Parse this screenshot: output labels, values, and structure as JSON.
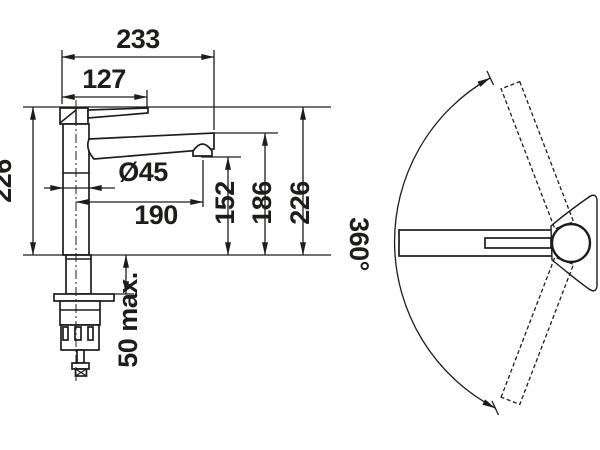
{
  "meta": {
    "description": "Technical dimension drawing of a single-lever kitchen mixer tap: side view with installation dimensions (mm) and top view showing spout swivel range",
    "background_color": "#ffffff",
    "line_color": "#1d1d1b"
  },
  "side_view": {
    "dims": {
      "total_width": "233",
      "lever_length": "127",
      "height_left": "226",
      "body_diameter": "Ø45",
      "spout_reach": "190",
      "outlet_height": "152",
      "spout_top_height": "186",
      "total_height": "226",
      "deck_thickness": "50 max."
    }
  },
  "top_view": {
    "swivel_range": "360°"
  }
}
